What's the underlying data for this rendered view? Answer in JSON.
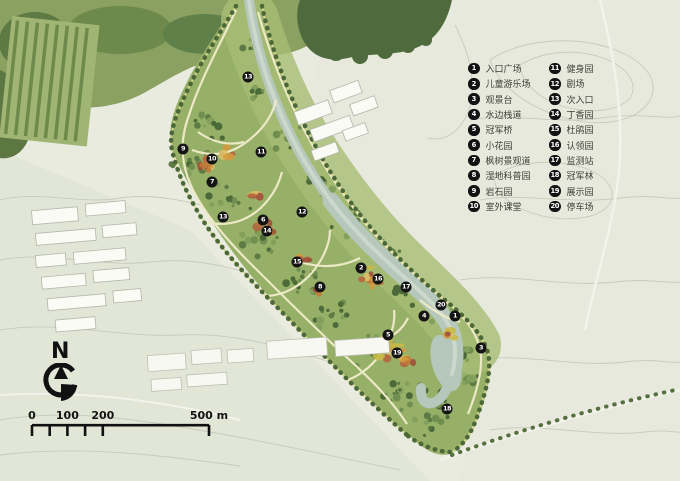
{
  "legend": {
    "items": [
      {
        "num": "1",
        "label": "入口广场"
      },
      {
        "num": "2",
        "label": "儿童游乐场"
      },
      {
        "num": "3",
        "label": "观景台"
      },
      {
        "num": "4",
        "label": "水边栈道"
      },
      {
        "num": "5",
        "label": "冠军桥"
      },
      {
        "num": "6",
        "label": "小花园"
      },
      {
        "num": "7",
        "label": "枫树景观道"
      },
      {
        "num": "8",
        "label": "湿地科普园"
      },
      {
        "num": "9",
        "label": "岩石园"
      },
      {
        "num": "10",
        "label": "室外课堂"
      },
      {
        "num": "11",
        "label": "健身园"
      },
      {
        "num": "12",
        "label": "剧场"
      },
      {
        "num": "13",
        "label": "次入口"
      },
      {
        "num": "14",
        "label": "丁香园"
      },
      {
        "num": "15",
        "label": "杜鹃园"
      },
      {
        "num": "16",
        "label": "认领园"
      },
      {
        "num": "17",
        "label": "监测站"
      },
      {
        "num": "18",
        "label": "冠军林"
      },
      {
        "num": "19",
        "label": "展示园"
      },
      {
        "num": "20",
        "label": "停车场"
      }
    ]
  },
  "markers": [
    {
      "num": "13",
      "x": 248,
      "y": 77
    },
    {
      "num": "9",
      "x": 183,
      "y": 149
    },
    {
      "num": "10",
      "x": 212,
      "y": 159
    },
    {
      "num": "11",
      "x": 261,
      "y": 152
    },
    {
      "num": "7",
      "x": 212,
      "y": 182
    },
    {
      "num": "12",
      "x": 302,
      "y": 212
    },
    {
      "num": "13",
      "x": 223,
      "y": 217
    },
    {
      "num": "6",
      "x": 263,
      "y": 220
    },
    {
      "num": "14",
      "x": 267,
      "y": 231
    },
    {
      "num": "15",
      "x": 297,
      "y": 262
    },
    {
      "num": "2",
      "x": 361,
      "y": 268
    },
    {
      "num": "16",
      "x": 378,
      "y": 279
    },
    {
      "num": "8",
      "x": 320,
      "y": 287
    },
    {
      "num": "17",
      "x": 406,
      "y": 287
    },
    {
      "num": "20",
      "x": 441,
      "y": 305
    },
    {
      "num": "4",
      "x": 424,
      "y": 316
    },
    {
      "num": "1",
      "x": 455,
      "y": 316
    },
    {
      "num": "5",
      "x": 388,
      "y": 335
    },
    {
      "num": "3",
      "x": 481,
      "y": 348
    },
    {
      "num": "19",
      "x": 397,
      "y": 353
    },
    {
      "num": "18",
      "x": 447,
      "y": 409
    }
  ],
  "compass": {
    "label": "N"
  },
  "scalebar": {
    "labels": [
      {
        "text": "0",
        "meters": 0
      },
      {
        "text": "100",
        "meters": 100
      },
      {
        "text": "200",
        "meters": 200
      },
      {
        "text": "500 m",
        "meters": 500
      }
    ],
    "tick_meters": [
      0,
      50,
      100,
      150,
      200,
      500
    ]
  },
  "colors": {
    "background": "#e9ebdf",
    "corridor_green": "#97b068",
    "forest_dark": "#4f6a3c",
    "river": "#b6c7bb",
    "path_cream": "#ece9c6",
    "marker_black": "#141414",
    "flower_orange": "#d59a40",
    "flower_red": "#a85a3a",
    "flower_yellow": "#ccbd4a"
  }
}
